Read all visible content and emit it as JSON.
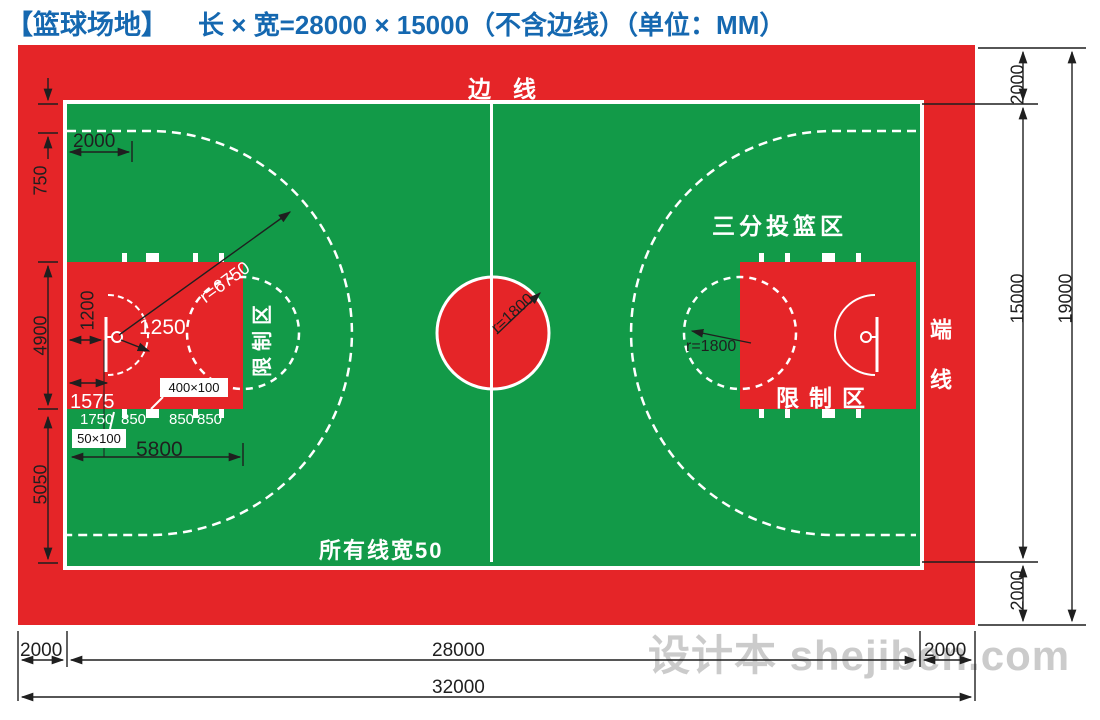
{
  "header": {
    "name": "【篮球场地】",
    "spec": "长 × 宽=28000 × 15000（不含边线）（单位：MM）"
  },
  "court_labels": {
    "sideline": "边线",
    "endline": "端线",
    "three_point_area": "三分投篮区",
    "restricted_area": "限制区",
    "restricted_area_side": "限制区",
    "line_width_note": "所有线宽50"
  },
  "dims": {
    "left": [
      "750",
      "4900",
      "5050"
    ],
    "top_left_offset": "2000",
    "key": {
      "backboard_offset": "1200",
      "no_charge_radius": "1250",
      "three_point_radius": "r=6750",
      "d1575": "1575",
      "block_400": "400×100",
      "block_50": "50×100",
      "lane_spacing": [
        "1750",
        "850",
        "850",
        "850"
      ],
      "key_length": "5800"
    },
    "center_circle_radius": "r=1800",
    "ft_circle_radius": "r=1800",
    "right": {
      "margin_top": "2000",
      "court_width": "15000",
      "margin_bottom": "2000",
      "total": "19000"
    },
    "bottom": {
      "margin_left": "2000",
      "court_length": "28000",
      "margin_right": "2000",
      "total": "32000"
    }
  },
  "colors": {
    "court_green": "#129a48",
    "margin_red": "#e52528",
    "line_white": "#ffffff",
    "title_blue": "#1568b0"
  },
  "watermark": "设计本 shejiben.com"
}
